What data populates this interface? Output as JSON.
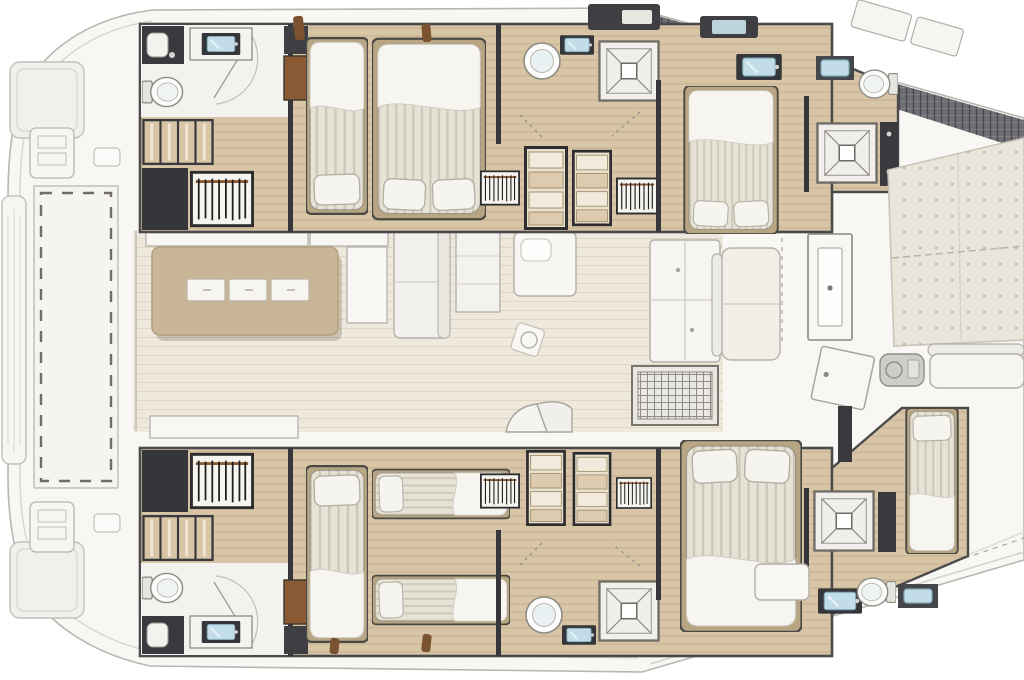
{
  "image": {
    "type": "yacht-floor-plan",
    "subject": "Top-down interior layout plan of a luxury catamaran, bow at left, stern at right",
    "width": 1024,
    "height": 680
  },
  "colors": {
    "background": "#ffffff",
    "deck_white": "#f8f7f4",
    "deck_panel": "#f5f4f1",
    "deck_outline": "#b9b6b0",
    "hull_band": "#6e6e74",
    "wood_floor": "#d7c5a6",
    "wood_floor_light": "#efe9dd",
    "dark_wall": "#3a3a3e",
    "furniture_white": "#f4f2ee",
    "bed_linen": "#e7e2d6",
    "pillow_white": "#f6f4ee",
    "wood_trim": "#b7a584",
    "hanger_rod_brown": "#8a5a34",
    "sink_blue": "#c3dde8",
    "table_tan": "#c9b696",
    "sunpad_beige": "#eae5da",
    "shelf_tan": "#e9e0cd"
  },
  "areas": {
    "foredeck": {
      "label": "Foredeck",
      "items": [
        "bow sunpad top",
        "bow sunpad bottom",
        "anchor console",
        "bow bench",
        "trampoline net",
        "deck hatches"
      ]
    },
    "saloon": {
      "label": "Saloon and galley",
      "items": [
        "dinette table with 3 placemats",
        "bench seating",
        "lounge sofa",
        "storage cabinet",
        "galley island",
        "tall galley cabinet",
        "cooktop",
        "aft sofa",
        "sliding door",
        "open door leaf",
        "floor ornament",
        "companionway steps"
      ]
    },
    "starboard_hull": {
      "label": "Starboard hull (top)",
      "items": [
        "forward head: shower, washbasin, toilet",
        "companion steps",
        "hanging wardrobe",
        "forepeak berth",
        "forward double cabin",
        "mid head: toilet, washbasin, shower",
        "storage units",
        "aft double cabin",
        "aft head: shower, washbasins, toilet"
      ]
    },
    "port_hull": {
      "label": "Port hull (bottom)",
      "items": [
        "forward head: shower, washbasin, toilet",
        "companion steps",
        "hanging wardrobe",
        "forepeak berth",
        "twin cabin with two single beds",
        "mid head: toilet, washbasin, shower",
        "storage units",
        "aft double cabin",
        "aft head: shower, washbasin, toilet",
        "aft crew berth"
      ]
    },
    "aft_deck": {
      "label": "Aft deck",
      "items": [
        "sunpad lounge",
        "bench seat",
        "grill",
        "deck locker",
        "transom steps",
        "coachroof band",
        "deck skylights"
      ]
    }
  },
  "counts": {
    "double_beds": 3,
    "single_beds": 5,
    "toilets": 6,
    "showers": 6,
    "washbasins": 8
  }
}
